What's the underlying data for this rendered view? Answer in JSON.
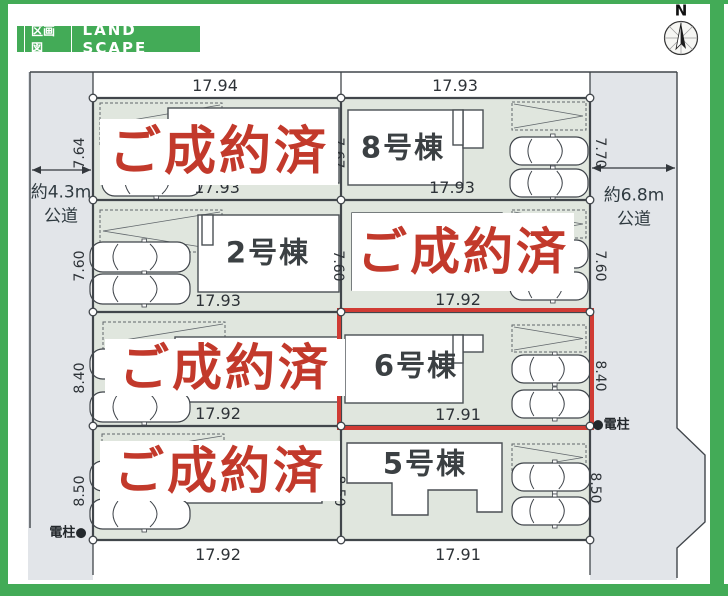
{
  "header": {
    "tag": "区画図",
    "title": "LAND SCAPE"
  },
  "compass": {
    "label": "N"
  },
  "roads": {
    "left": {
      "width": "約4.3m",
      "type": "公道"
    },
    "right": {
      "width": "約6.8m",
      "type": "公道"
    }
  },
  "poles": {
    "bottom_left": "電柱●",
    "right": "●電柱"
  },
  "stamp": {
    "text": "ご成約済"
  },
  "lots": {
    "lot8": {
      "name": "8号棟"
    },
    "lot2": {
      "name": "2号棟"
    },
    "lot6": {
      "name": "6号棟"
    },
    "lot5": {
      "name": "5号棟"
    }
  },
  "dims": {
    "top_left": "17.94",
    "top_right": "17.93",
    "r1_left": "7.64",
    "r1_center": "7.67",
    "r1_right": "7.70",
    "r1_bottom_left": "17.93",
    "r1_bottom_right": "17.93",
    "r2_left": "7.60",
    "r2_center": "7.60",
    "r2_right": "7.60",
    "r2_bottom_left": "17.93",
    "r2_bottom_right": "17.92",
    "r3_left": "8.40",
    "r3_center": "8.40",
    "r3_right": "8.40",
    "r3_bottom_left": "17.92",
    "r3_bottom_right": "17.91",
    "r4_left": "8.50",
    "r4_center": "8.50",
    "r4_right": "8.50",
    "bottom_left": "17.92",
    "bottom_right": "17.91"
  },
  "colors": {
    "accent_green": "#43ab57",
    "stamp_red": "#c2392b",
    "highlight_red": "#d03b34",
    "road_fill": "#e2e5e9",
    "lot_fill": "#e0e6de"
  }
}
